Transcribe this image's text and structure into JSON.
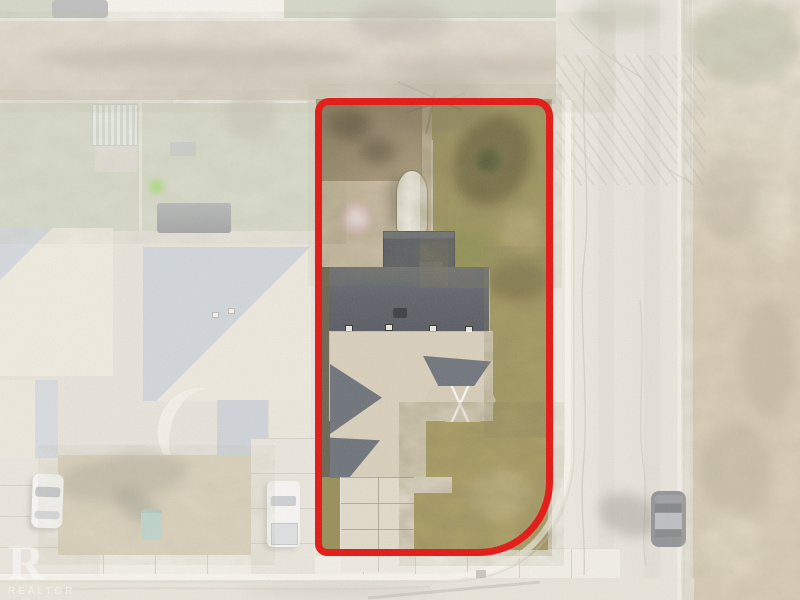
{
  "scene": {
    "type": "aerial-drone-photograph",
    "description": "Overhead real-estate photo of a corner residential lot outlined in red; surroundings faded white: gravel alley at top, neighboring homes at left, road and open field at right, street and sidewalk at bottom",
    "watermark": {
      "logo_letter": "R",
      "label": "REALTOR"
    },
    "highlight": {
      "name": "property-boundary",
      "color": "#e51410"
    },
    "elements": [
      "subject-house",
      "rv-trailer",
      "back-deck",
      "bay-window-roof",
      "concrete-driveway",
      "gravel-alley",
      "side-road",
      "open-field",
      "sidewalk",
      "street",
      "neighbor-houses",
      "white-car",
      "white-truck",
      "dark-car",
      "garbage-bin",
      "trampoline",
      "greenhouse",
      "bare-trees"
    ],
    "palette": {
      "pavement": "#ddd6c7",
      "sidewalk": "#e8e3d5",
      "alley_gravel": "#c6baa5",
      "field": "#c2ac85",
      "neighbor_grass": "#bdc2a7",
      "subject_grass": "#a39960",
      "subject_gravel": "#c9bca4",
      "dark_roof": "#5f6369",
      "light_roof": "#d9cfbb",
      "deck": "#565b62",
      "trailer": "#f0eee3",
      "trampoline": "#79c832",
      "garbage_bin": "#93bcae",
      "dark_car": "#45484c",
      "white_vehicles": "#f3f2ee"
    }
  }
}
